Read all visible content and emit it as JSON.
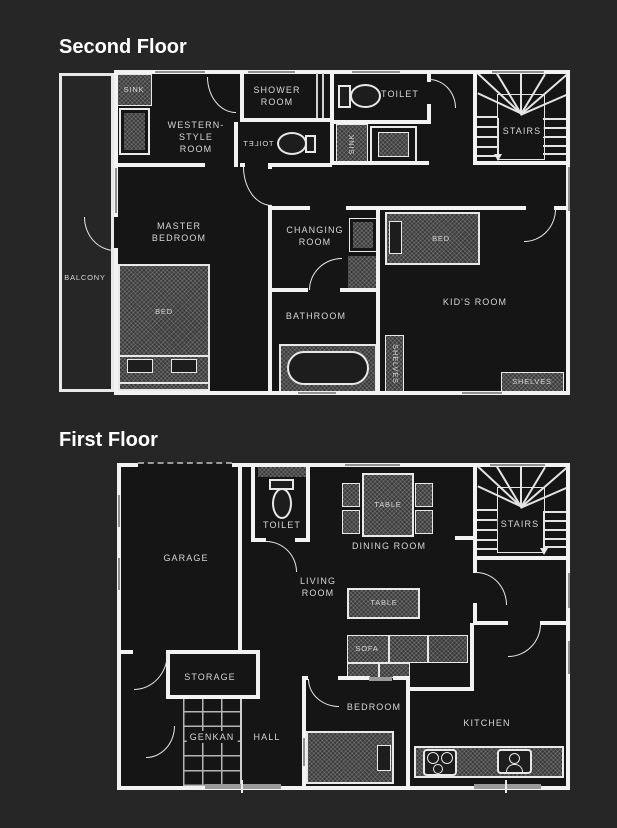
{
  "colors": {
    "page_bg": "#262626",
    "floor_bg": "#151515",
    "wall": "#f2f2f2",
    "label": "#d6d6d6",
    "window_marker": "#8f8f8f",
    "furniture_texture": "#3a3a3a"
  },
  "second_floor": {
    "title": "Second Floor",
    "labels": {
      "sink_vanity": "SINK",
      "western_room": "WESTERN-\nSTYLE\nROOM",
      "shower_room": "SHOWER\nROOM",
      "toilet_mirrored": "TOILET",
      "toilet": "TOILET",
      "sink_counter": "SINK",
      "stairs": "STAIRS",
      "balcony": "BALCONY",
      "master_bedroom": "MASTER\nBEDROOM",
      "master_bed": "BED",
      "changing_room": "CHANGING\nROOM",
      "bathroom": "BATHROOM",
      "shelves_tall": "SHELVES",
      "kids_bed": "BED",
      "kids_room": "KID'S ROOM",
      "shelves_low": "SHELVES"
    }
  },
  "first_floor": {
    "title": "First Floor",
    "labels": {
      "garage": "GARAGE",
      "toilet": "TOILET",
      "dining_table": "TABLE",
      "dining_room": "DINING ROOM",
      "stairs": "STAIRS",
      "living_room": "LIVING\nROOM",
      "living_table": "TABLE",
      "sofa": "SOFA",
      "storage": "STORAGE",
      "genkan": "GENKAN",
      "hall": "HALL",
      "bedroom": "BEDROOM",
      "kitchen": "KITCHEN"
    }
  }
}
